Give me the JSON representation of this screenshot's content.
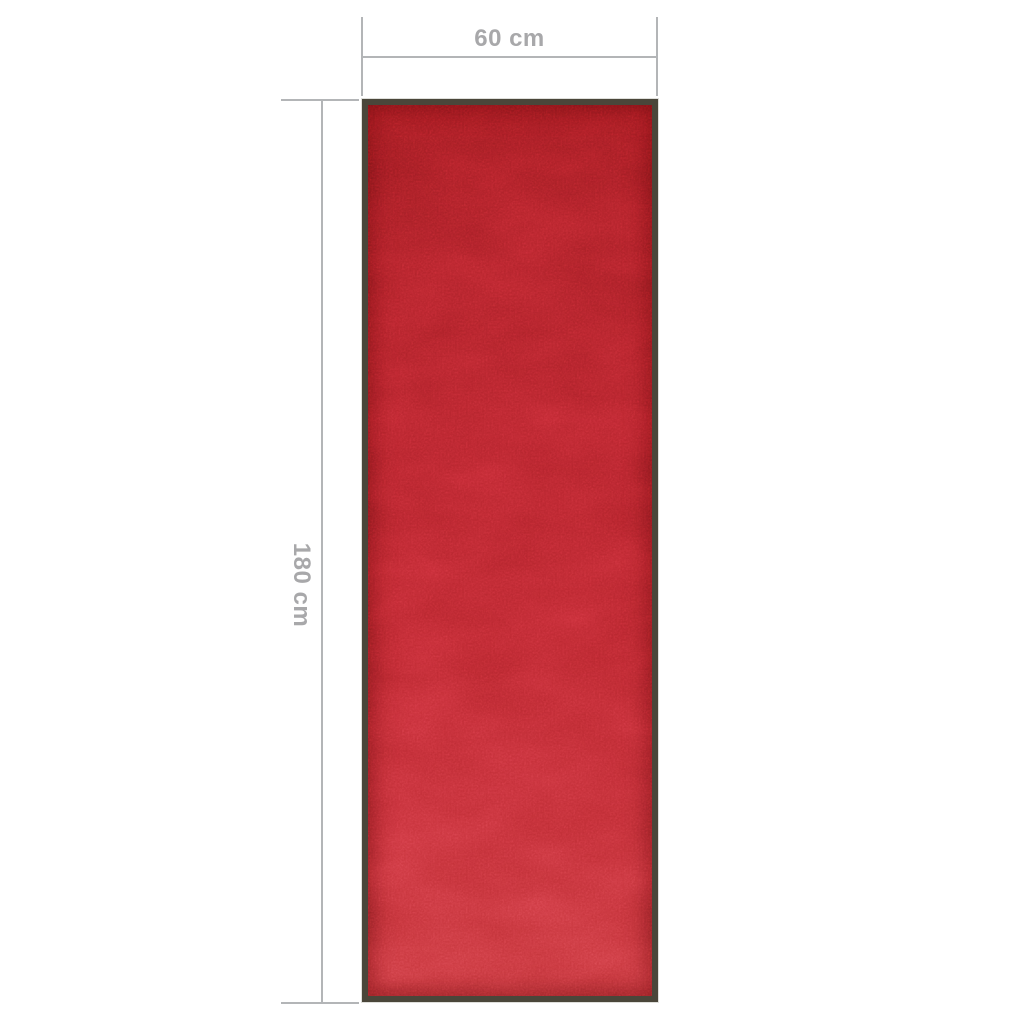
{
  "image": {
    "background_color": "#ffffff"
  },
  "dimension_annotations": {
    "width_label": "60 cm",
    "height_label": "180 cm",
    "line_color": "#b3b5b7",
    "text_color": "#a8a8aa"
  },
  "mat": {
    "carpet_color_top": "#97191f",
    "carpet_color_middle": "#b4242c",
    "carpet_color_bottom": "#c4343a",
    "border_color": "#4a463a"
  }
}
